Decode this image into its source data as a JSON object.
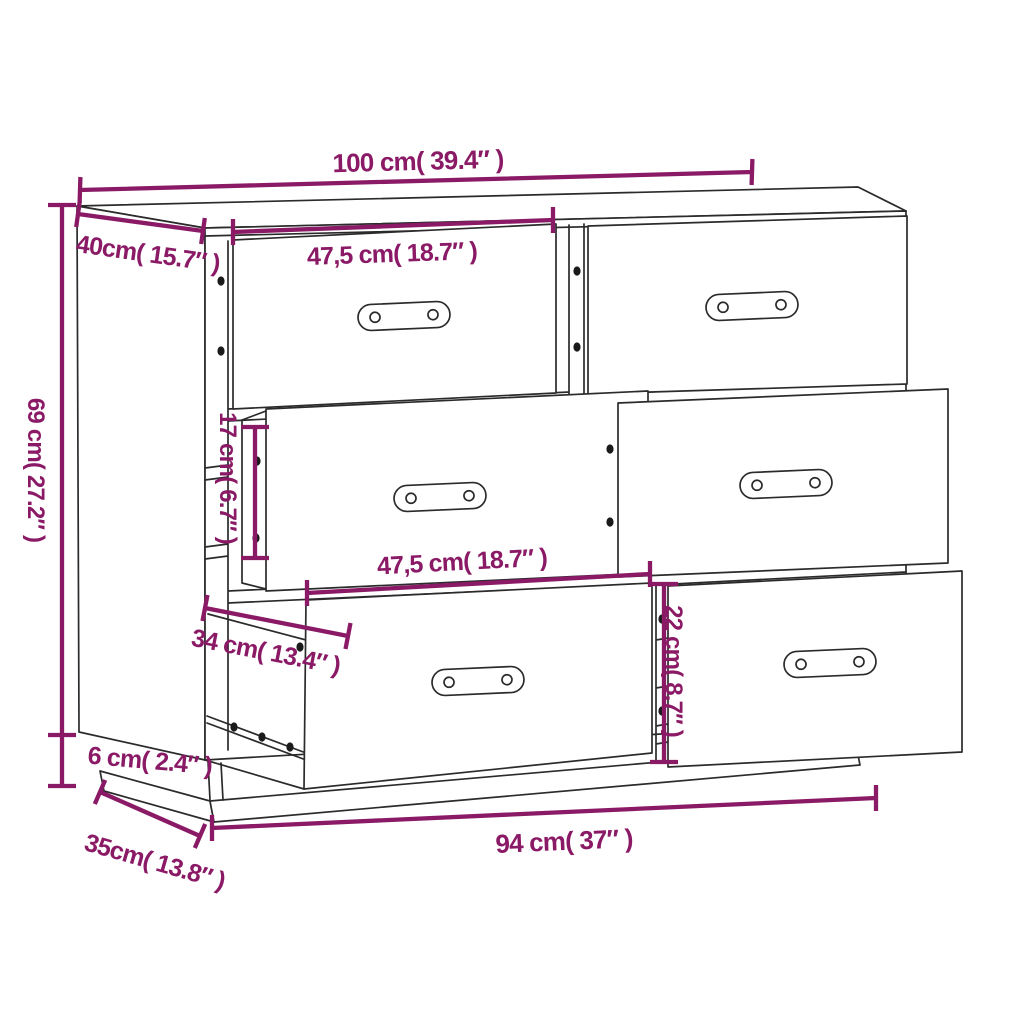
{
  "page": {
    "background": "#ffffff"
  },
  "style": {
    "dimension_color": "#8b1a66",
    "line_color": "#2b2b2b"
  },
  "diagram": {
    "subject": "sideboard-with-6-drawers-dimension-drawing",
    "dimensions": {
      "overall_width": "100 cm( 39.4″ )",
      "depth": "40cm( 15.7″ )",
      "overall_height": "69 cm( 27.2″ )",
      "top_drawer_width": "47,5 cm( 18.7″ )",
      "middle_drawer_front_height": "17 cm( 6.7″ )",
      "middle_drawer_width": "47,5 cm( 18.7″ )",
      "drawer_extension_depth": "34 cm( 13.4″ )",
      "bottom_drawer_front_height": "22 cm( 8.7″ )",
      "plinth_height": "6 cm( 2.4″ )",
      "base_depth": "35cm( 13.8″ )",
      "base_width": "94 cm( 37″ )"
    }
  }
}
